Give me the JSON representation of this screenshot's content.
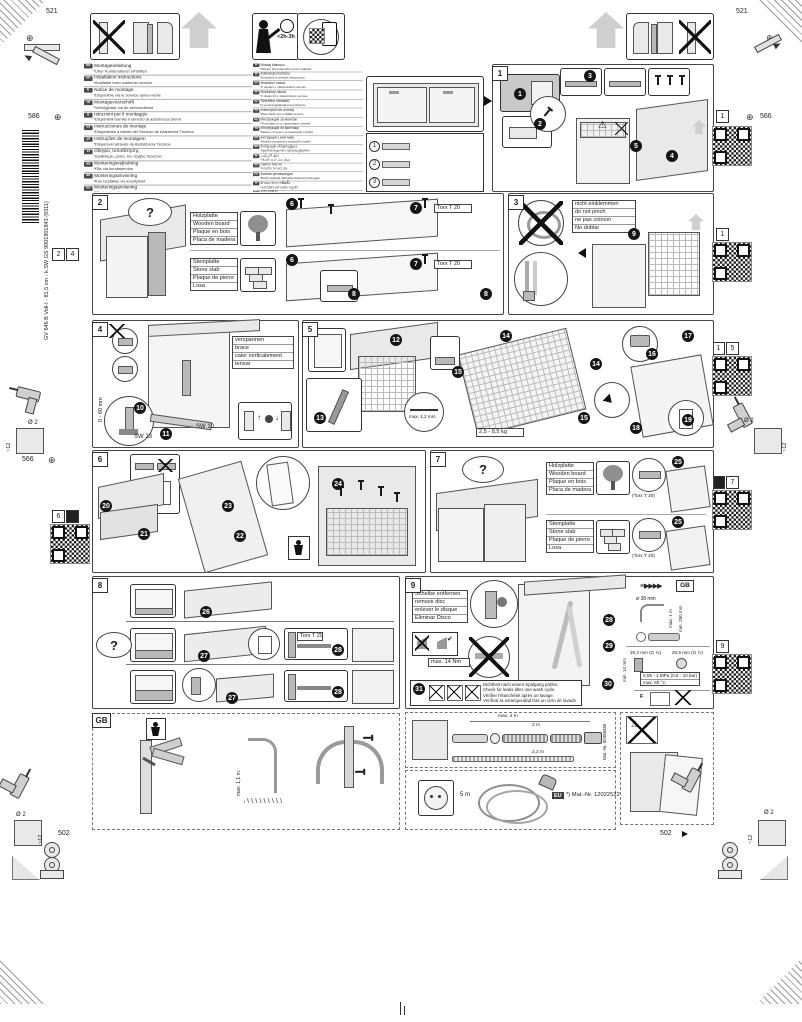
{
  "page": {
    "product_code": "GV 646 B Voll-I - 81,5 cm - k.SW  GS 9001901843 (9311)",
    "reg": {
      "top": "521",
      "left_upper": "586",
      "left_lower": "566",
      "right_upper": "566",
      "bottom": "502"
    },
    "drill": {
      "diameter": "Ø 2",
      "depth": "~12"
    },
    "duration": "<2h-3h",
    "margin_refs": {
      "l1": "2",
      "l2": "4",
      "l3": "6",
      "r1": "1",
      "r2": "1",
      "r3a": "1",
      "r3b": "5",
      "r4": "7",
      "r5": "9"
    }
  },
  "common": {
    "question": "?",
    "torx": "Torx T 20",
    "torx_paren": "(Torx T 20)",
    "wood": [
      "Holzplatte",
      "Wooden board",
      "Plaque en bois",
      "Placa de madera"
    ],
    "stone": [
      "Steinplatte",
      "Stone slab",
      "Plaque de pierre",
      "Losa"
    ]
  },
  "languages": {
    "left": [
      {
        "c": "de",
        "t": "Montageanleitung",
        "n": "*Über Kundendienst erhältlich"
      },
      {
        "c": "en",
        "t": "Installation instructions",
        "n": "*Available from customer service"
      },
      {
        "c": "fr",
        "t": "Notice de montage",
        "n": "*Disponible via le service après-vente"
      },
      {
        "c": "nl",
        "t": "Montagevoorschrift",
        "n": "*Verkrijgbaar via de servicedienst"
      },
      {
        "c": "it",
        "t": "Istruzioni per il montaggio",
        "n": "*Disponibili tramite il servizio di assistenza clienti"
      },
      {
        "c": "es",
        "t": "Instrucciones de montaje",
        "n": "*Disponibles a través del Servicio de Asistencia Técnica"
      },
      {
        "c": "pt",
        "t": "Instruções de montagem",
        "n": "*Disponível através da Assistência Técnica"
      },
      {
        "c": "el",
        "t": "Οδηγίες τοποθέτησης",
        "n": "*Διαθέσιμες μέσω του σέρβις πελατών"
      },
      {
        "c": "da",
        "t": "Monteringsvejledning",
        "n": "*Fås via kundeservice"
      },
      {
        "c": "sv",
        "t": "Monteringsanvisning",
        "n": "*Kan beställas via kundtjänst"
      },
      {
        "c": "no",
        "t": "Monteringsanvisning",
        "n": "*Fås hos kundeservice"
      },
      {
        "c": "fi",
        "t": "Asennusohje",
        "n": "*Saatavana huoltopalvelusta"
      }
    ],
    "right": [
      {
        "c": "tr",
        "t": "Montaj kılavuzu",
        "n": "*Müşteri hizmetlerinden temin edilebilir"
      },
      {
        "c": "pl",
        "t": "Instrukcja montażu",
        "n": "*Dostępna w serwisie fabrycznym"
      },
      {
        "c": "cs",
        "t": "Montážní návod",
        "n": "*K dostání u zákaznického servisu"
      },
      {
        "c": "sk",
        "t": "Montážny návod",
        "n": "*K dispozícii v zákazníckom servise"
      },
      {
        "c": "hu",
        "t": "Szerelési útmutató",
        "n": "*A vevőszolgálatnál szerezhető be"
      },
      {
        "c": "ro",
        "t": "Instrucţiuni de montaj",
        "n": "*Disponibile prin unităţile service"
      },
      {
        "c": "bg",
        "t": "Инструкция за монтаж",
        "n": "*Получава се от сервизната служба"
      },
      {
        "c": "ru",
        "t": "Инструкция по монтажу",
        "n": "*Можно получить в сервисной службе"
      },
      {
        "c": "uk",
        "t": "Інструкція з монтажу",
        "n": "*Можна отримати в сервісній службі"
      },
      {
        "c": "ka",
        "t": "მონტაჟის ინსტრუქცია",
        "n": "*ხელმისაწვდომია სერვისცენტრში"
      },
      {
        "c": "ar",
        "t": "دليل التركيب",
        "n": "*متوفر لدى خدمة العملاء"
      },
      {
        "c": "he",
        "t": "הוראות התקנה",
        "n": "*זמין בשירות הלקוחות"
      },
      {
        "c": "ms",
        "t": "Arahan pemasangan",
        "n": "*Boleh didapati daripada Khidmat Pelanggan"
      },
      {
        "c": "th",
        "t": "คำแนะนำการติดตั้ง",
        "n": "*ขอรับได้จากฝ่ายบริการลูกค้า"
      },
      {
        "c": "ko",
        "t": "설치 설명서",
        "n": "*고객 서비스에서 구입 가능"
      },
      {
        "c": "zh",
        "t": "安裝說明",
        "n": "*可向客戶服務中心索取"
      },
      {
        "c": "zh",
        "t": "安装说明",
        "n": "*可向客户服务部门索取"
      }
    ]
  },
  "p1": {
    "label": "1",
    "s": [
      "1",
      "2",
      "3",
      "4",
      "5"
    ],
    "parts": [
      "1",
      "2",
      "3",
      "4",
      "5",
      "6",
      "7",
      "8"
    ]
  },
  "p2": {
    "label": "2",
    "s": [
      "6",
      "7",
      "8"
    ]
  },
  "p3": {
    "label": "3",
    "s": [
      "9"
    ],
    "note": [
      "nicht einklemmen",
      "do not pinch",
      "ne pas coincer",
      "No doblar"
    ]
  },
  "p4": {
    "label": "4",
    "s": [
      "10",
      "11"
    ],
    "note": [
      "verspannen",
      "brace",
      "caler verticalement",
      "tensar"
    ],
    "range": "0 - 60 mm",
    "sw13": "SW 13",
    "sw10": "SW 10"
  },
  "p5": {
    "label": "5",
    "s": [
      "12",
      "13",
      "14",
      "15",
      "16",
      "17",
      "18",
      "19"
    ],
    "gap": "max. 1,2 mm",
    "weight": "2,5 - 8,5 kg"
  },
  "p6": {
    "label": "6",
    "s": [
      "20",
      "21",
      "22",
      "23",
      "24"
    ]
  },
  "p7": {
    "label": "7",
    "s": [
      "25"
    ]
  },
  "p8": {
    "label": "8",
    "s": [
      "26",
      "27",
      "28"
    ]
  },
  "p9": {
    "label": "9",
    "s": [
      "28",
      "29",
      "30",
      "31"
    ],
    "skip": "GB",
    "remove": [
      "Scheibe entfernen",
      "remove disc",
      "enlever le disque",
      "Eliminar Disco"
    ],
    "torque": "max. 14 Nm",
    "drain": {
      "dia": "ø 38 mm",
      "h1": "max. 1 m",
      "h2": "min. 280 mm"
    },
    "water": {
      "w1": "26,4 mm (G ¾)",
      "w2": "20,9 mm (G ½)",
      "min": "min. 10 mm",
      "press": "0,05 - 1 MPa (0,5 - 10 bar)",
      "temp": "max. 60 °C",
      "force": "F"
    },
    "leak": [
      "Dichtheit nach einem Spülgang prüfen.",
      "Check for leaks after one wash cycle.",
      "Vérifier l'étanchéité après un lavage.",
      "Verificar la estanqueidad tras un ciclo de lavado."
    ]
  },
  "gb": {
    "label": "GB",
    "maxh": "max. 1,1 m"
  },
  "hose": {
    "total": "max. 4 m",
    "l1": "2 m",
    "l2": "2,2 m",
    "mat": "Mat.-Nr. 00358356"
  },
  "power": {
    "len": "5 m",
    "region": "EU",
    "mat": "*) Mat.-Nr. 12022522"
  }
}
